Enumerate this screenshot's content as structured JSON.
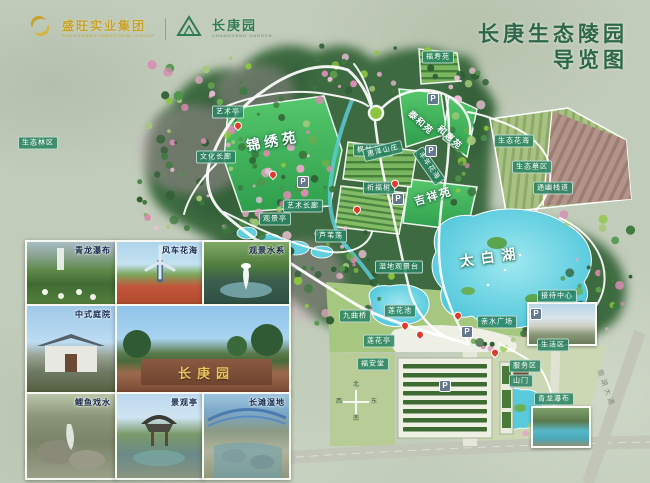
{
  "header": {
    "logo_group": {
      "text": "盛旺实业集团",
      "subtext": "SHENGWANG INDUSTRIAL GROUP"
    },
    "logo_park": {
      "text": "长庚园",
      "subtext": "CHANGGENG GARDEN"
    },
    "title_line1": "长庚生态陵园",
    "title_line2": "导览图"
  },
  "photos": [
    {
      "label": "青龙瀑布",
      "kind": "waterfall"
    },
    {
      "label": "风车花海",
      "kind": "windmill"
    },
    {
      "label": "观景水系",
      "kind": "fountain"
    },
    {
      "label": "中式庭院",
      "kind": "courtyard"
    },
    {
      "label": "",
      "kind": "entrance",
      "sign_text": "长庚园"
    },
    {
      "label": "鲤鱼戏水",
      "kind": "rocks"
    },
    {
      "label": "景观亭",
      "kind": "pavilion"
    },
    {
      "label": "长滩湿地",
      "kind": "bridge"
    }
  ],
  "map": {
    "area_labels": [
      {
        "text": "锦绣苑",
        "x": 273,
        "y": 141,
        "size": 14,
        "rot": -10,
        "ls": 4
      },
      {
        "text": "泰和苑",
        "x": 421,
        "y": 122,
        "size": 9,
        "rot": 42,
        "ls": 1
      },
      {
        "text": "和惠苑",
        "x": 450,
        "y": 137,
        "size": 9,
        "rot": 42,
        "ls": 1
      },
      {
        "text": "吉祥苑",
        "x": 433,
        "y": 196,
        "size": 11,
        "rot": -16,
        "ls": 2
      },
      {
        "text": "太白湖",
        "x": 491,
        "y": 257,
        "size": 14,
        "rot": -8,
        "ls": 7
      }
    ],
    "poi_labels": [
      {
        "text": "生态林区",
        "x": 38,
        "y": 143
      },
      {
        "text": "艺术亭",
        "x": 228,
        "y": 112
      },
      {
        "text": "文化长廊",
        "x": 216,
        "y": 157
      },
      {
        "text": "枫林花海",
        "x": 373,
        "y": 150
      },
      {
        "text": "祈福树",
        "x": 379,
        "y": 188
      },
      {
        "text": "艺术长廊",
        "x": 303,
        "y": 206
      },
      {
        "text": "观景亭",
        "x": 275,
        "y": 219
      },
      {
        "text": "芦苇荡",
        "x": 331,
        "y": 236
      },
      {
        "text": "惠泽山庄",
        "x": 383,
        "y": 151,
        "rot": -14
      },
      {
        "text": "丰年花海",
        "x": 429,
        "y": 166,
        "rot": 55
      },
      {
        "text": "福寿苑",
        "x": 438,
        "y": 57
      },
      {
        "text": "生态花海",
        "x": 514,
        "y": 141
      },
      {
        "text": "生态墓区",
        "x": 532,
        "y": 167
      },
      {
        "text": "通幽栈道",
        "x": 553,
        "y": 188
      },
      {
        "text": "湿地观景台",
        "x": 399,
        "y": 267
      },
      {
        "text": "接待中心",
        "x": 557,
        "y": 296
      },
      {
        "text": "亲水广场",
        "x": 497,
        "y": 322
      },
      {
        "text": "生活区",
        "x": 553,
        "y": 345
      },
      {
        "text": "服务区",
        "x": 525,
        "y": 366
      },
      {
        "text": "山门",
        "x": 521,
        "y": 381
      },
      {
        "text": "青龙瀑布",
        "x": 554,
        "y": 399
      },
      {
        "text": "九曲桥",
        "x": 355,
        "y": 316
      },
      {
        "text": "莲花池",
        "x": 400,
        "y": 311
      },
      {
        "text": "莲花亭",
        "x": 379,
        "y": 341
      },
      {
        "text": "福安堂",
        "x": 373,
        "y": 364
      }
    ],
    "parking": {
      "symbol": "P",
      "positions": [
        [
          303,
          182
        ],
        [
          433,
          99
        ],
        [
          431,
          151
        ],
        [
          398,
          199
        ],
        [
          536,
          314
        ],
        [
          467,
          332
        ],
        [
          445,
          386
        ]
      ]
    },
    "pins": [
      [
        238,
        128
      ],
      [
        273,
        177
      ],
      [
        357,
        212
      ],
      [
        395,
        186
      ],
      [
        405,
        328
      ],
      [
        420,
        337
      ],
      [
        458,
        318
      ],
      [
        495,
        355
      ]
    ],
    "compass": {
      "north": "北",
      "south": "南",
      "east": "东",
      "west": "西"
    },
    "road_label": "南湖大道"
  }
}
